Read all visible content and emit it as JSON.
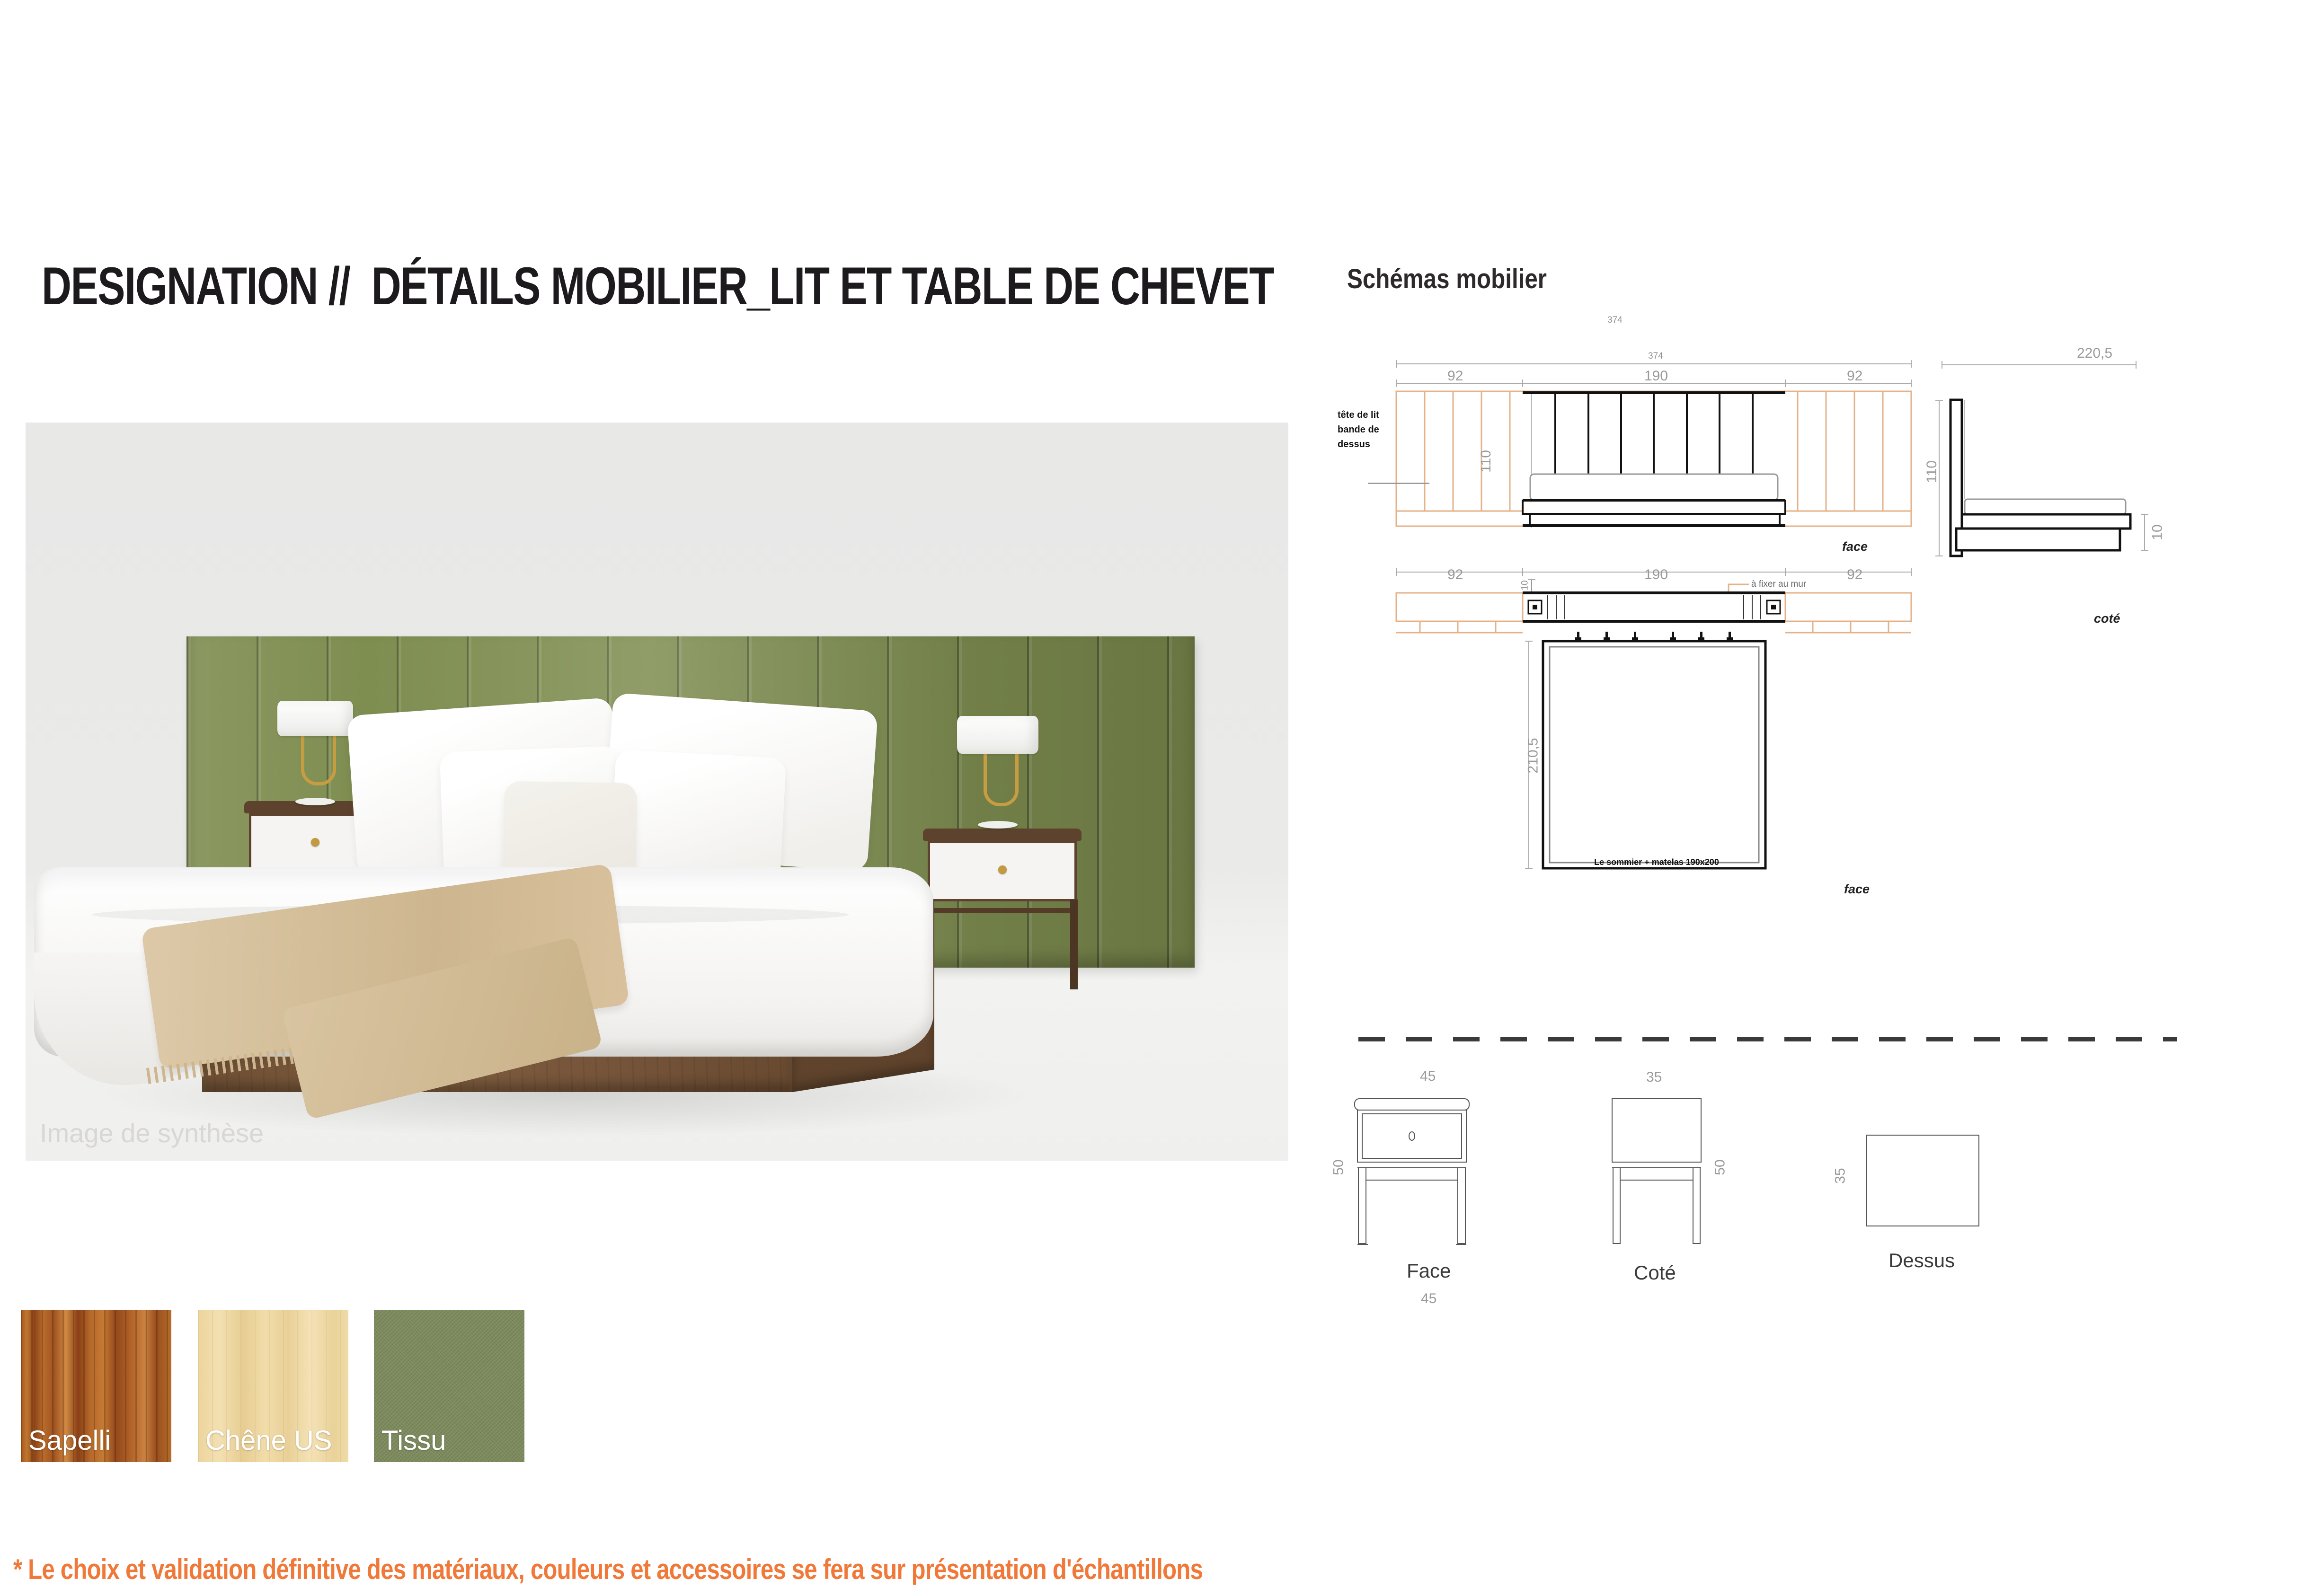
{
  "page": {
    "title": "DESIGNATION //  DÉTAILS MOBILIER_LIT ET TABLE DE CHEVET",
    "footnote": "* Le choix et validation définitive des matériaux, couleurs et accessoires se fera sur présentation d'échantillons"
  },
  "photo": {
    "caption": "Image de synthèse"
  },
  "schematics": {
    "heading": "Schémas mobilier",
    "bed_front": {
      "total_width": "374",
      "segments": [
        "92",
        "190",
        "92"
      ],
      "height": "110",
      "caption": "face",
      "annotation": [
        "tête de lit",
        "bande de",
        "dessus"
      ]
    },
    "bed_side": {
      "length": "220,5",
      "height": "110",
      "base_height": "10",
      "caption": "coté"
    },
    "bed_plan": {
      "segments": [
        "92",
        "190",
        "92"
      ],
      "lip": "10",
      "depth": "210,5",
      "wall_note": "à fixer au mur",
      "inner_note": "Le sommier + matelas 190x200",
      "caption": "face"
    },
    "nightstand": {
      "top_width": "45",
      "side_width": "35",
      "height": "50",
      "top_depth": "35",
      "bottom_width": "45",
      "captions": {
        "front": "Face",
        "side": "Coté",
        "top": "Dessus"
      }
    }
  },
  "materials": [
    {
      "name": "Sapelli",
      "color": "#a85c23"
    },
    {
      "name": "Chêne US",
      "color": "#eed6a0"
    },
    {
      "name": "Tissu",
      "color": "#7c8a5c"
    }
  ],
  "colors": {
    "accent_orange": "#f0793a",
    "drawing_tan": "#e5b288",
    "fabric_green": "#7e8d50",
    "dim_gray": "#9a9a9a",
    "ink": "#1d1a1e"
  }
}
